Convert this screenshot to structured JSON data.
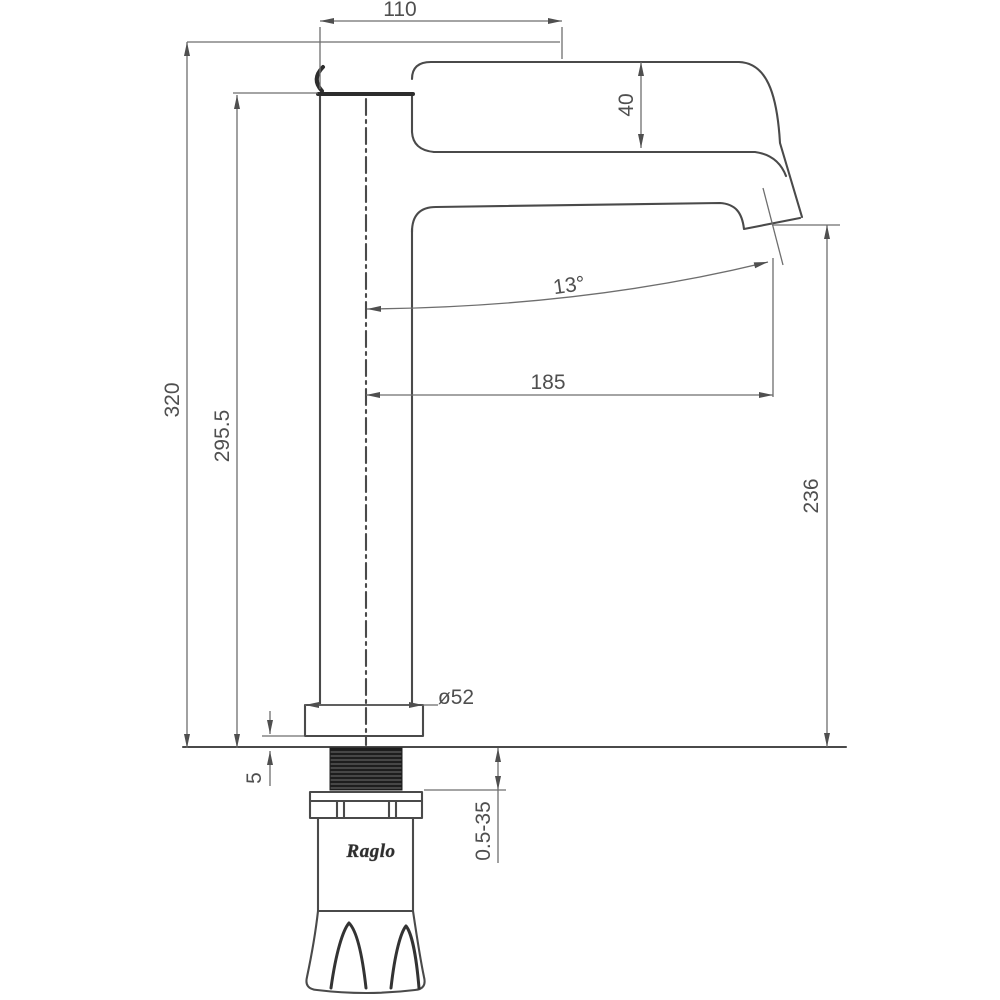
{
  "drawing": {
    "kind": "technical-dimension-drawing",
    "subject": "tall single-lever basin mixer faucet, side elevation",
    "background": "#ffffff",
    "object_line_color": "#4a4a4a",
    "dimension_line_color": "#6e6e6e",
    "brand": "Raglo",
    "dims": {
      "width_top": "110",
      "handle_height": "40",
      "spout_angle": "13°",
      "spout_reach": "185",
      "height_total": "320",
      "height_body": "295.5",
      "height_outlet": "236",
      "base_diameter": "ø52",
      "base_plate": "5",
      "deck_thickness_range": "0.5-35"
    }
  }
}
